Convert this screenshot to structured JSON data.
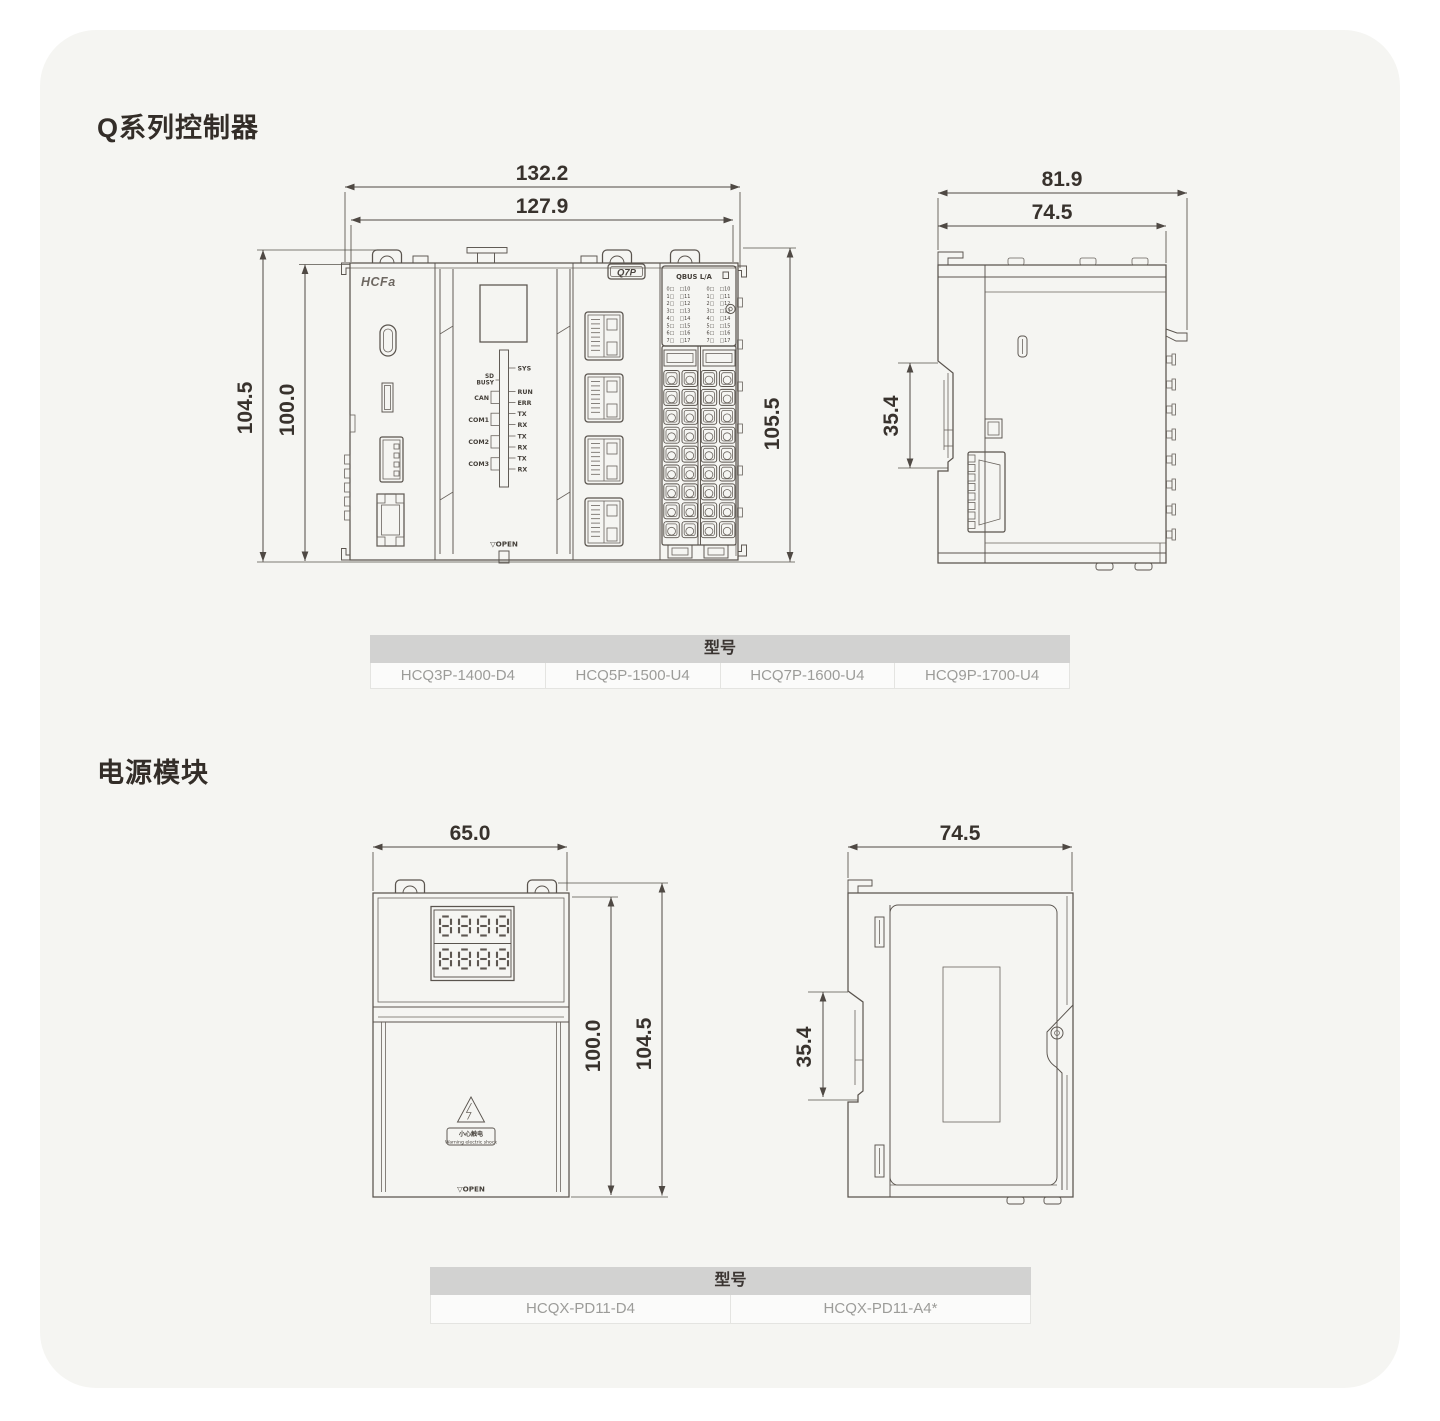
{
  "page": {
    "card_bg": "#f5f5f2",
    "table_header_bg": "#d2d2d1",
    "model_text_color": "#9c9c99",
    "line_color": "#5a544e"
  },
  "sections": {
    "controller_title": "Q系列控制器",
    "power_title": "电源模块"
  },
  "controller": {
    "front": {
      "dim_width_outer": "132.2",
      "dim_width_inner": "127.9",
      "dim_height_outer": "104.5",
      "dim_height_inner": "100.0",
      "dim_height_right": "105.5",
      "brand": "HCFa",
      "cpu_badge": "Q7P",
      "io_header": "QBUS L/A",
      "open_label": "▽OPEN",
      "led_right": [
        "SYS",
        "RUN",
        "ERR",
        "TX",
        "RX",
        "TX",
        "RX",
        "TX",
        "RX"
      ],
      "led_left_top": [
        "SD",
        "BUSY"
      ],
      "led_left": [
        "CAN",
        "COM1",
        "COM2",
        "COM3"
      ],
      "io_rows": [
        "0",
        "1",
        "2",
        "3",
        "4",
        "5",
        "6",
        "7"
      ]
    },
    "side": {
      "dim_depth_outer": "81.9",
      "dim_depth_inner": "74.5",
      "dim_din": "35.4"
    },
    "table": {
      "header": "型号",
      "models": [
        "HCQ3P-1400-D4",
        "HCQ5P-1500-U4",
        "HCQ7P-1600-U4",
        "HCQ9P-1700-U4"
      ]
    }
  },
  "power": {
    "front": {
      "dim_width": "65.0",
      "dim_height_inner": "100.0",
      "dim_height_outer": "104.5",
      "display_row1": "8888",
      "display_row2": "8888",
      "warning_cn": "小心触电",
      "warning_en": "Warning electric shock",
      "open_label": "▽OPEN"
    },
    "side": {
      "dim_depth": "74.5",
      "dim_din": "35.4"
    },
    "table": {
      "header": "型号",
      "models": [
        "HCQX-PD11-D4",
        "HCQX-PD11-A4*"
      ]
    }
  }
}
